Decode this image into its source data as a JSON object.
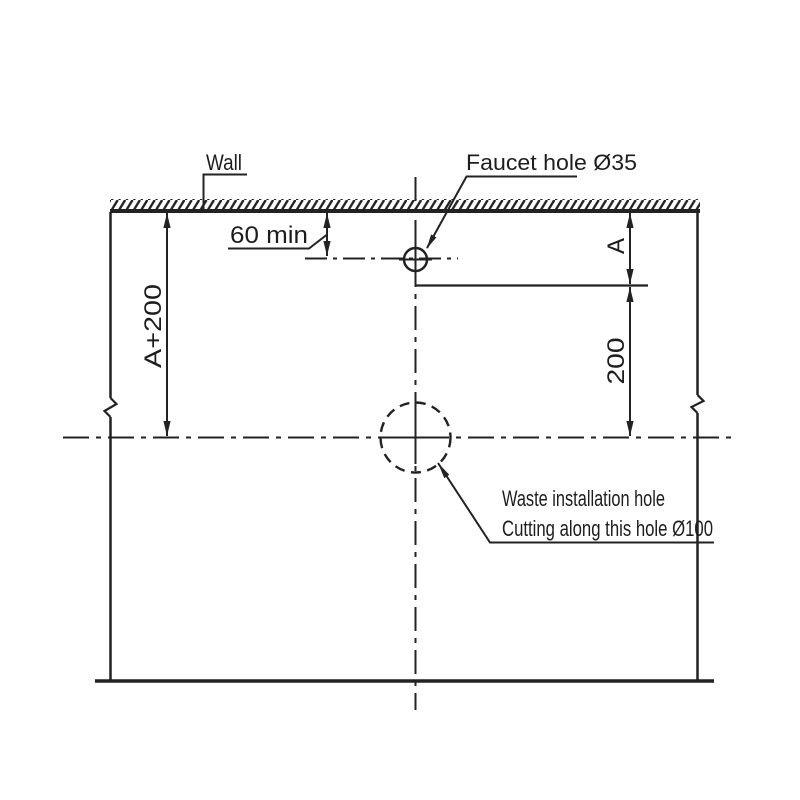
{
  "drawing": {
    "type": "installation-drawing",
    "colors": {
      "line": "#222222",
      "background": "#ffffff",
      "text": "#1d1d1d"
    },
    "labels": {
      "wall": "Wall",
      "faucet_hole": "Faucet hole Ø35",
      "waste_line1": "Waste installation hole",
      "waste_line2": "Cutting along this hole Ø100"
    },
    "dimensions": {
      "wall_to_faucet_centerline": "60 min",
      "total_depth": "A+200",
      "faucet_offset": "A",
      "faucet_to_waste": "200"
    }
  }
}
